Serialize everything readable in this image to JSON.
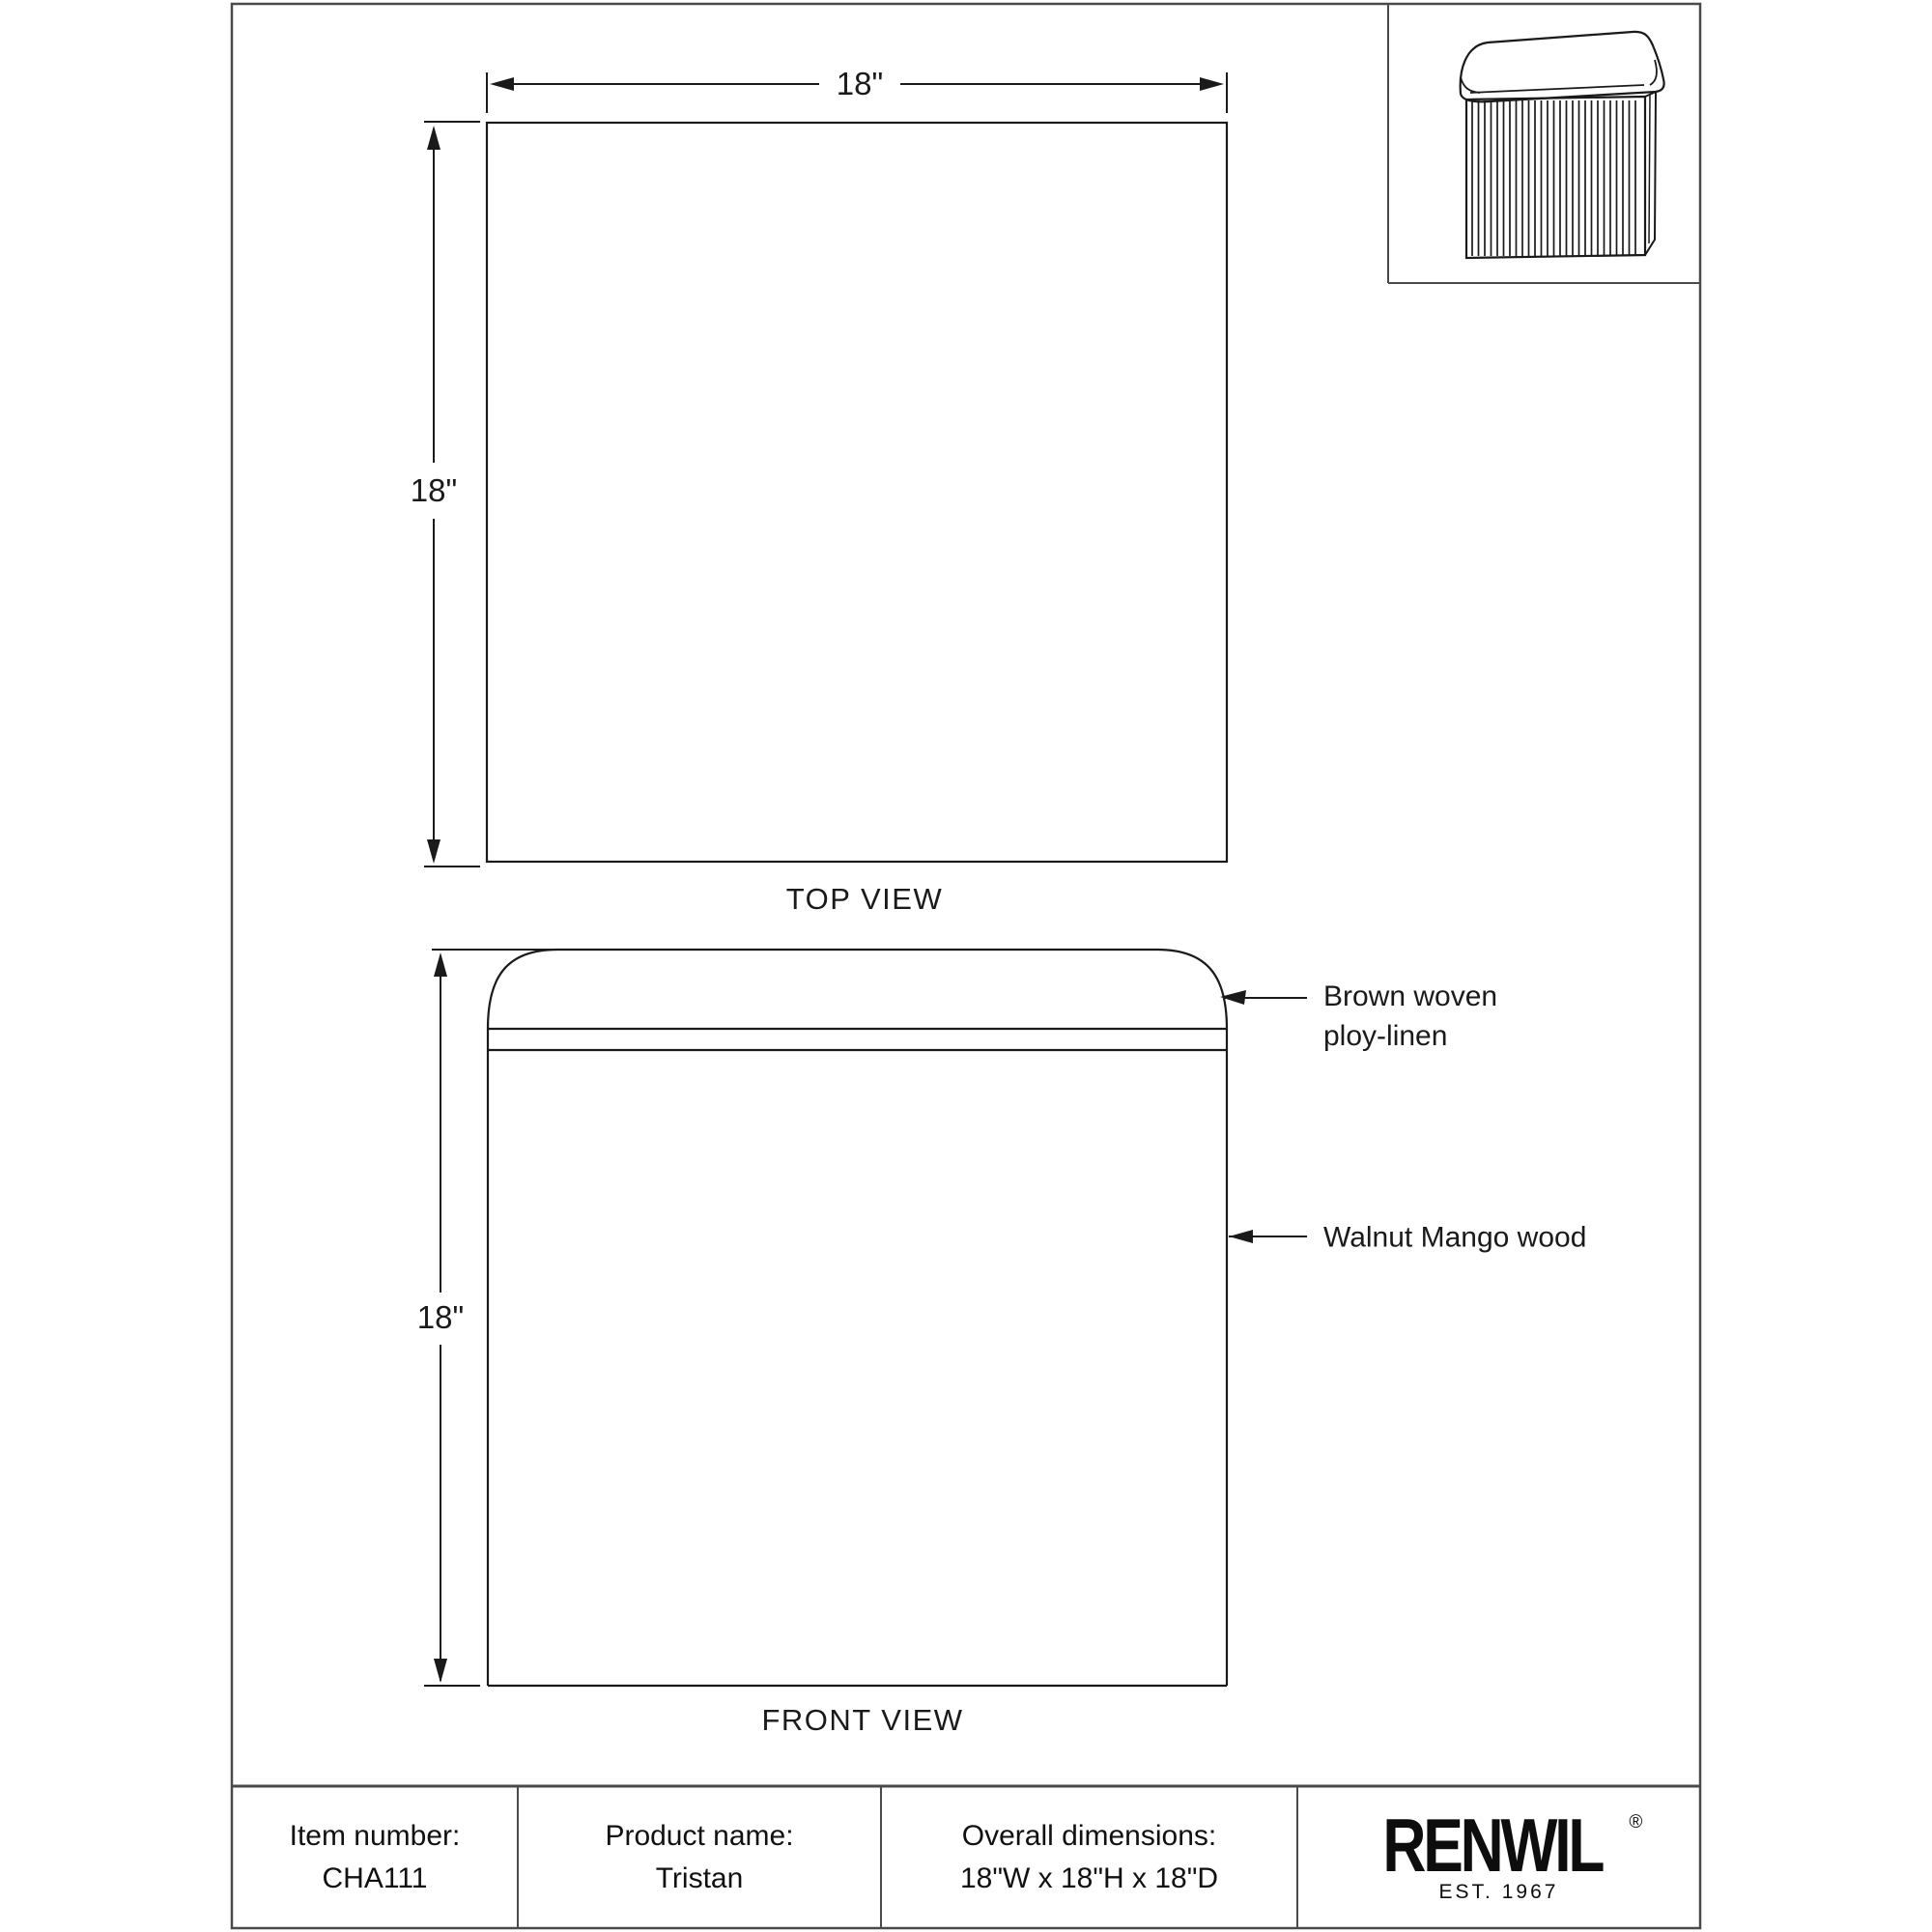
{
  "page": {
    "background": "#ffffff",
    "line_color": "#1a1a1a",
    "frame_color": "#4a4a4a"
  },
  "top_view": {
    "label": "TOP VIEW",
    "width_dim": "18\"",
    "height_dim": "18\""
  },
  "front_view": {
    "label": "FRONT VIEW",
    "height_dim": "18\""
  },
  "annotations": {
    "cushion_line1": "Brown woven",
    "cushion_line2": "ploy-linen",
    "body": "Walnut Mango wood"
  },
  "thumbnail": {
    "description": "ottoman-isometric-thumbnail"
  },
  "footer": {
    "cells": [
      {
        "label": "Item number:",
        "value": "CHA111"
      },
      {
        "label": "Product name:",
        "value": "Tristan"
      },
      {
        "label": "Overall dimensions:",
        "value": "18\"W x 18\"H x 18\"D"
      }
    ],
    "brand": {
      "name": "RENWIL",
      "registered": "®",
      "est": "EST. 1967"
    }
  }
}
